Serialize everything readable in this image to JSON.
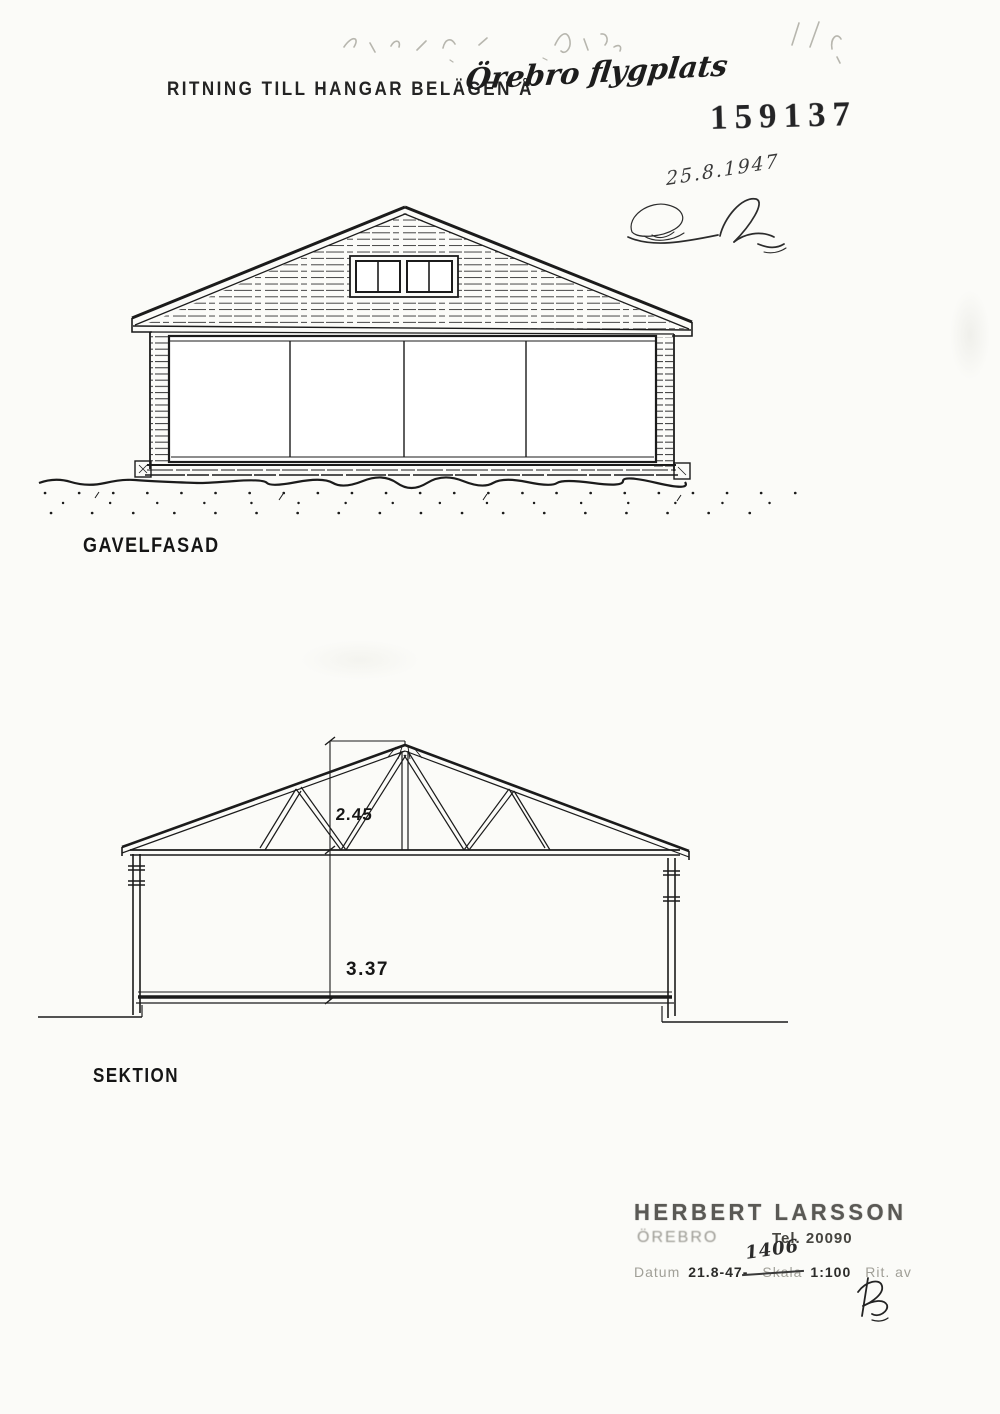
{
  "header": {
    "title_printed": "RITNING TILL HANGAR BELÄGEN Å",
    "title_handwritten": "Örebro flygplats",
    "archive_number": "159137",
    "date_handwritten": "25.8.1947"
  },
  "drawings": {
    "facade": {
      "label": "GAVELFASAD"
    },
    "section": {
      "label": "SEKTION",
      "dim_roof_height": "2.45",
      "dim_wall_height": "3.37"
    }
  },
  "stamp": {
    "name": "HERBERT LARSSON",
    "city": "ÖREBRO",
    "phone": "Tel. 20090",
    "date_label": "Datum",
    "date_value": "21.8-47-",
    "scale_label": "Skala",
    "scale_value": "1:100",
    "scale_handwritten": "1406",
    "drawn_by_label": "Rit. av"
  },
  "colors": {
    "paper": "#fbfbf8",
    "ink": "#1b1b1b",
    "pencil": "#b7b6ae",
    "stamp_faded": "#9a9992"
  }
}
